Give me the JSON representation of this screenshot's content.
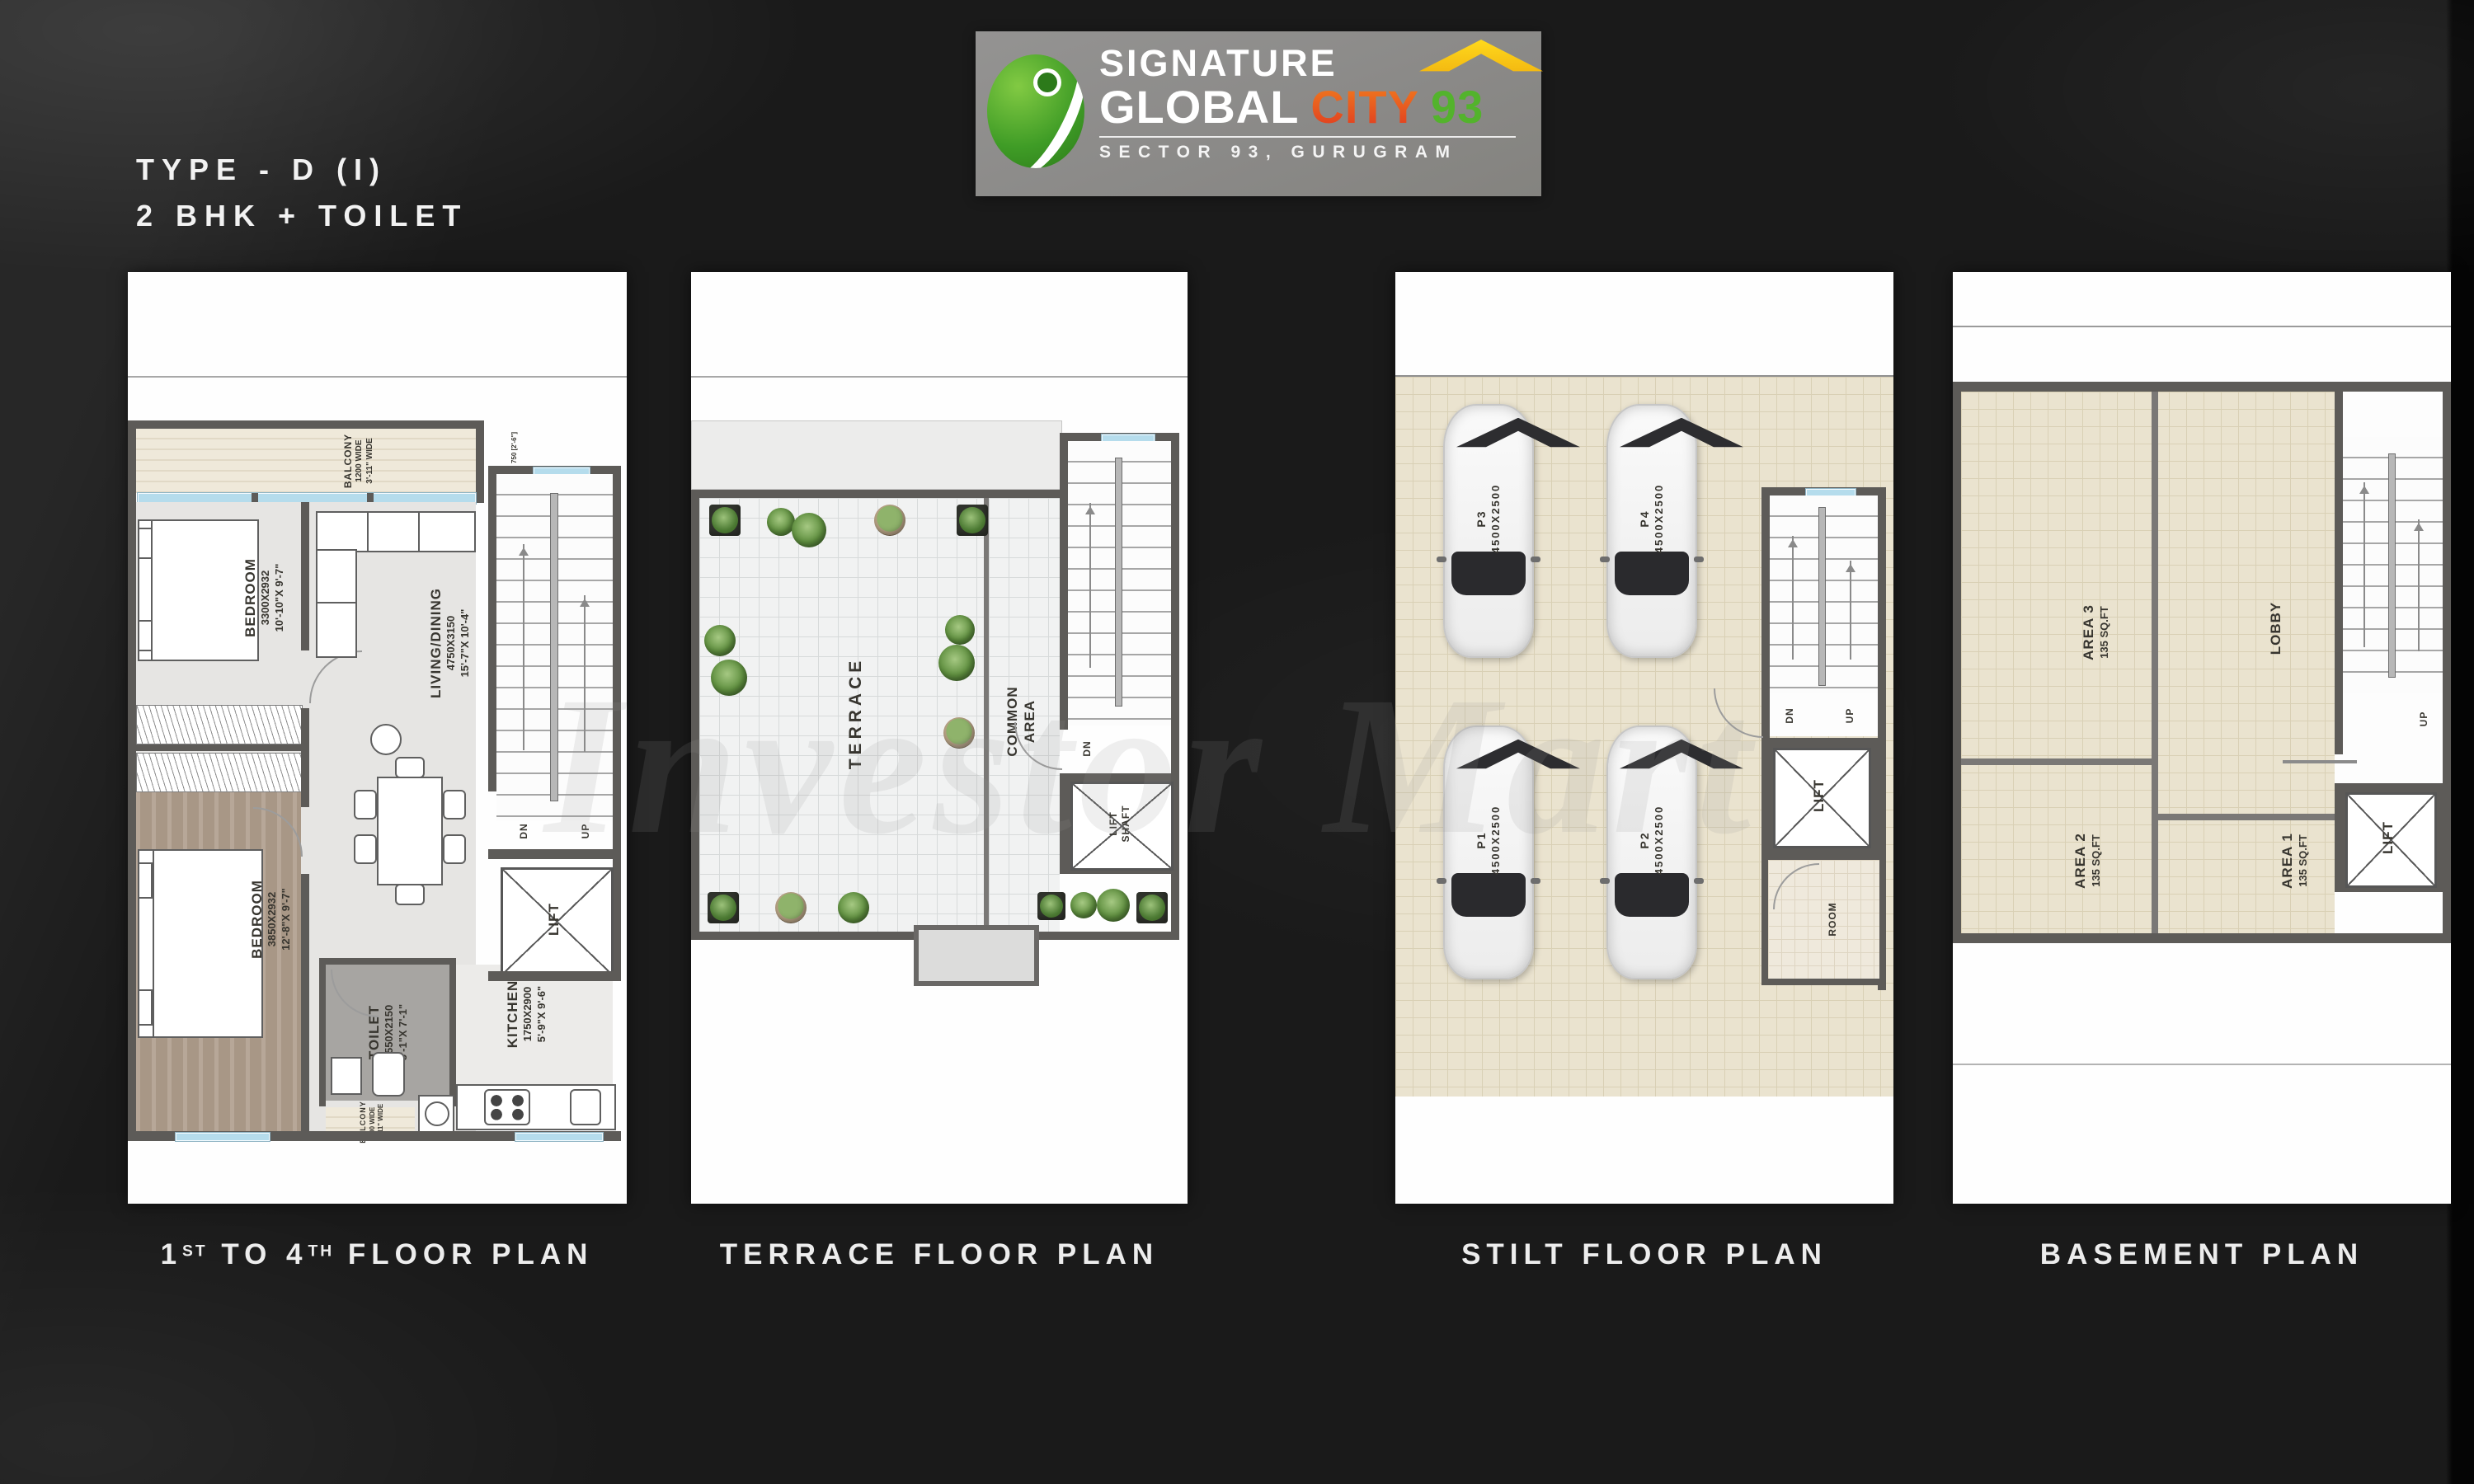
{
  "colors": {
    "background": "#1a1a1a",
    "panel": "#fefefe",
    "wall": "#5d5b58",
    "tile_beige": "#eae3cf",
    "tile_white": "#f1f2f2",
    "window_blue": "#b5dcec",
    "logo_bg": "#8e8d8b",
    "logo_city_orange": "#e8502a",
    "logo_93_green": "#53b32c",
    "logo_roof_yellow": "#f7c413"
  },
  "header": {
    "type_title": "TYPE - D (I)",
    "subtitle": "2 BHK + TOILET"
  },
  "logo": {
    "word1": "SIGNATURE",
    "word2": "GLOBAL",
    "word3": "CITY",
    "word4": "93",
    "tagline": "SECTOR 93, GURUGRAM",
    "mark": "signature-global-leaf-logo",
    "roof_icon": "house-roof-icon"
  },
  "watermark": "Investor Mart",
  "panels": {
    "floor": {
      "caption": {
        "n1": "1",
        "s1": "ST",
        "t1": " TO 4",
        "s2": "TH",
        "t2": " FLOOR PLAN"
      },
      "balcony_top": {
        "name": "BALCONY",
        "l1": "1200 WIDE",
        "l2": "3'-11\" WIDE"
      },
      "dim_right": "750 [2'-6\"]",
      "bedroom1": {
        "name": "BEDROOM",
        "l1": "3300X2932",
        "l2": "10'-10\"X 9'-7\""
      },
      "living": {
        "name": "LIVING/DINING",
        "l1": "4750X3150",
        "l2": "15'-7\"X 10'-4\""
      },
      "bedroom2": {
        "name": "BEDROOM",
        "l1": "3850X2932",
        "l2": "12'-8\"X 9'-7\""
      },
      "toilet": {
        "name": "TOILET",
        "l1": "1550X2150",
        "l2": "5'-1\"X 7'-1\""
      },
      "kitchen": {
        "name": "KITCHEN",
        "l1": "1750X2900",
        "l2": "5'-9\"X 9'-6\""
      },
      "balcony_small": {
        "name": "BALCONY",
        "l1": "900 WIDE",
        "l2": "2'-11\" WIDE"
      },
      "lift": "LIFT",
      "dn": "DN",
      "up": "UP"
    },
    "terrace": {
      "caption": "TERRACE FLOOR PLAN",
      "terrace": "TERRACE",
      "common_l1": "COMMON",
      "common_l2": "AREA",
      "lift_l1": "LIFT",
      "lift_l2": "SHAFT",
      "dn": "DN"
    },
    "stilt": {
      "caption": "STILT FLOOR PLAN",
      "cars": [
        {
          "label": "P3",
          "dim": "4500X2500"
        },
        {
          "label": "P4",
          "dim": "4500X2500"
        },
        {
          "label": "P1",
          "dim": "4500X2500"
        },
        {
          "label": "P2",
          "dim": "4500X2500"
        }
      ],
      "dn": "DN",
      "up": "UP",
      "lift": "LIFT",
      "room": "ROOM"
    },
    "basement": {
      "caption": "BASEMENT PLAN",
      "area3": {
        "name": "AREA 3",
        "size": "135 SQ.FT"
      },
      "lobby": "LOBBY",
      "area2": {
        "name": "AREA 2",
        "size": "135 SQ.FT"
      },
      "area1": {
        "name": "AREA 1",
        "size": "135 SQ.FT"
      },
      "up": "UP",
      "lift": "LIFT"
    }
  }
}
